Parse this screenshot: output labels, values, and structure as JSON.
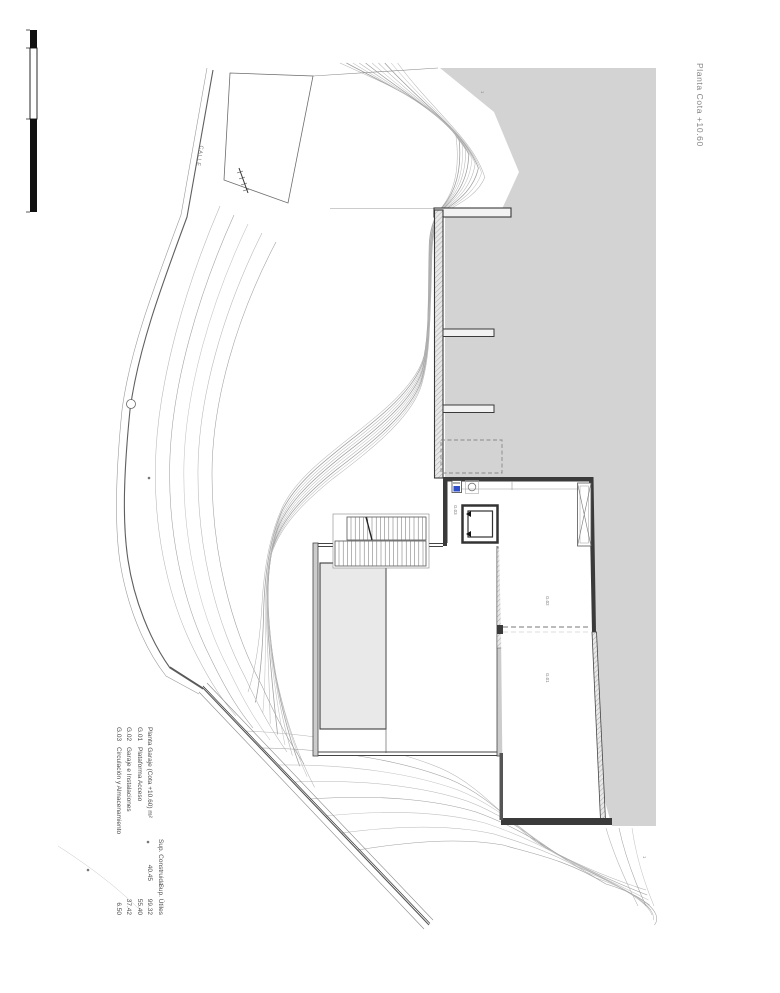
{
  "sheet": {
    "title_rotated": "Planta Cota +10.60"
  },
  "site": {
    "street_label": "CALLE"
  },
  "rooms": [
    {
      "code": "G.01"
    },
    {
      "code": "G.02"
    },
    {
      "code": "G.03"
    }
  ],
  "annotations": {
    "elevation_mark_top": "1",
    "elevation_mark_bottom": "1"
  },
  "legend": {
    "headers": {
      "construida": "Sup. Construida",
      "utiles": "Sup. Útiles"
    },
    "rows": [
      {
        "code": "",
        "name": "Planta Garaje (Cota +10.60) m²",
        "construida": "40.45",
        "utiles": "99.32"
      },
      {
        "code": "G.01",
        "name": "Plataforma Acceso",
        "construida": "",
        "utiles": "55.40"
      },
      {
        "code": "G.02",
        "name": "Garaje e Instalaciones",
        "construida": "",
        "utiles": "37.42"
      },
      {
        "code": "G.03",
        "name": "Circulación y Almacenamiento",
        "construida": "",
        "utiles": "6.50"
      }
    ]
  },
  "colors": {
    "terrain_gray": "#d3d3d3",
    "pool_gray": "#e9e9e9",
    "wall_dark": "#3a3a3a",
    "contour": "#a8a8a8",
    "accent_blue": "#2f4ec9"
  }
}
